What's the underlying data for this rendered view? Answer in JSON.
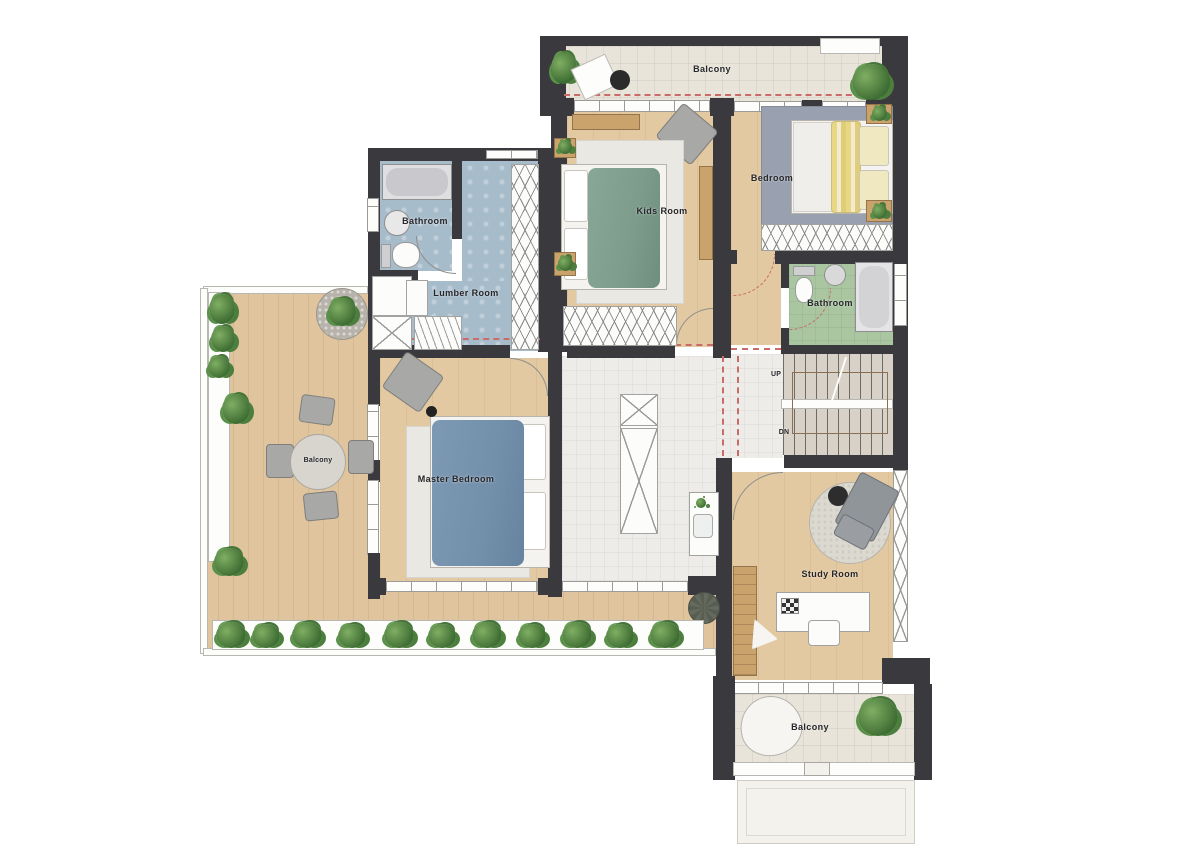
{
  "floorplan": {
    "rooms": {
      "balcony_top": {
        "label": "Balcony"
      },
      "kids_room": {
        "label": "Kids Room"
      },
      "bedroom": {
        "label": "Bedroom"
      },
      "bathroom_right": {
        "label": "Bathroom"
      },
      "bathroom_left": {
        "label": "Bathroom"
      },
      "lumber_room": {
        "label": "Lumber Room"
      },
      "master_bedroom": {
        "label": "Master Bedroom"
      },
      "terrace": {
        "label": "Balcony"
      },
      "study_room": {
        "label": "Study Room"
      },
      "balcony_bottom": {
        "label": "Balcony"
      }
    },
    "stairs": {
      "up": "UP",
      "down": "DN"
    },
    "colors": {
      "wall": "#3a393d",
      "wood": "#e3c9a1",
      "deck": "#dfc49d",
      "tile_balcony": "#e8e4da",
      "tile_hall": "#edece8",
      "bath_blue": "#a7bcca",
      "bath_green": "#a9c6a1",
      "rug_gray": "#99a1b0",
      "stairs": "#d8d1c7",
      "accent": "#c96b67",
      "plant_green": "#4c7f3d",
      "blanket_teal": "#7d9c8c",
      "blanket_blue": "#7390ab",
      "blanket_yellow": "#e9d883"
    }
  }
}
